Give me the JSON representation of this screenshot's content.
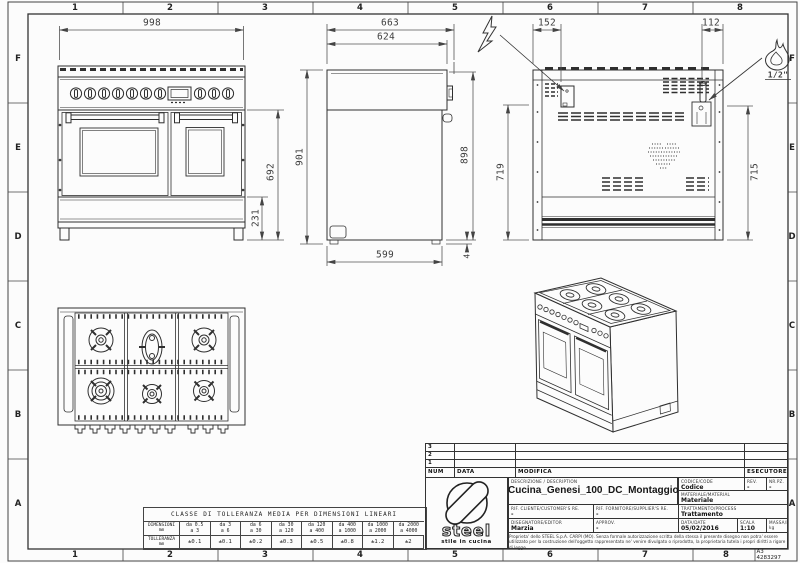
{
  "sheet": {
    "code": "A3 4283297"
  },
  "border": {
    "cols": [
      "1",
      "2",
      "3",
      "4",
      "5",
      "6",
      "7",
      "8"
    ],
    "rows": [
      "F",
      "E",
      "D",
      "C",
      "B",
      "A"
    ]
  },
  "dims": {
    "front_width": "998",
    "front_oven_height": "692",
    "front_plinth_height": "231",
    "side_depth_total": "663",
    "side_depth_top": "624",
    "side_height_front": "901",
    "side_height_back": "898",
    "side_depth_bottom": "599",
    "side_foot": "4",
    "back_elec_offset": "152",
    "back_gas_offset": "112",
    "back_height_left": "719",
    "back_height_right": "715"
  },
  "annotations": {
    "gas_size": "1/2\""
  },
  "tolerance_table": {
    "title": "CLASSE DI TOLLERANZA MEDIA PER DIMENSIONI LINEARI",
    "dim_label": "DIMENSIONI\nmm",
    "tol_label": "TOLLERANZA\nmm",
    "ranges": [
      "da 0.5\na 3",
      "da 3\na 6",
      "da 6\na 30",
      "da 30\na 120",
      "da 120\na 400",
      "da 400\na 1000",
      "da 1000\na 2000",
      "da 2000\na 4000"
    ],
    "tolerances": [
      "±0.1",
      "±0.1",
      "±0.2",
      "±0.3",
      "±0.5",
      "±0.8",
      "±1.2",
      "±2"
    ]
  },
  "title_block": {
    "revisions": [
      "3",
      "2",
      "1"
    ],
    "headers": {
      "num": "NUM",
      "data": "DATA",
      "modifica": "MODIFICA",
      "esecutore": "ESECUTORE"
    },
    "logo": {
      "name": "steel",
      "tagline": "stile in cucina"
    },
    "fields": {
      "description_label": "DESCRIZIONE / DESCRIPTION",
      "description": "Cucina_Genesi_100_DC_Montaggio",
      "code_label": "CODICE/CODE",
      "code": "Codice",
      "rev_label": "REV.",
      "rev": "-",
      "nrpz_label": "NR.PZ.",
      "nrpz": "-",
      "material_label": "MATERIALE/MATERIAL",
      "material": "Materiale",
      "client_ref_label": "RIF. CLIENTE/CUSTOMER'S RE.",
      "client_ref": "-",
      "supplier_ref_label": "RIF. FORNITORE/SUPPLIER'S RE.",
      "supplier_ref": "-",
      "treatment_label": "TRATTAMENTO/PROCESS",
      "treatment": "Trattamento",
      "designer_label": "DISEGNATORE/EDITOR",
      "designer": "Marzia",
      "approv_label": "APPROV.",
      "approv": "-",
      "date_label": "DATA/DATE",
      "date": "05/02/2016",
      "scale_label": "SCALA",
      "scale": "1:10",
      "mass_label": "MASSA/MASS kg",
      "mass": "-"
    },
    "legal": "Proprieta' dello STEEL S.p.A. CARPI (MO). Senza formale autorizzazione scritta della stessa il presente disegno non potra' essere utilizzato per la costruzione dell'oggetto rappresentato ne' venire divulgato o riprodotto, la proprietaria tutela i propri diritti a rigore di legge."
  }
}
